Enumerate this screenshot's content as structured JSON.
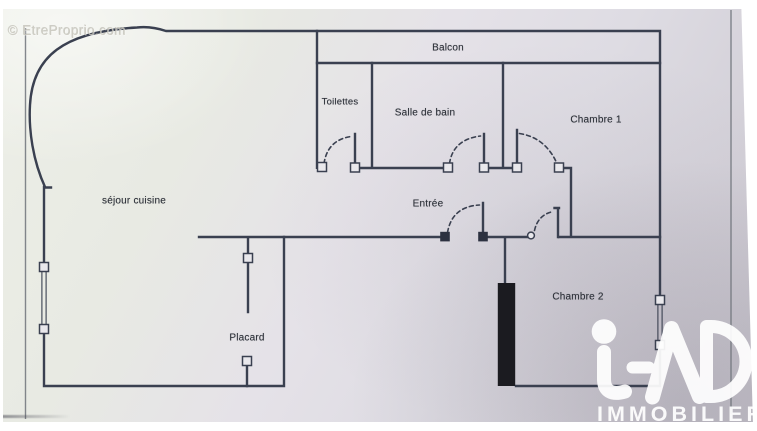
{
  "watermark": {
    "text": "© EtreProprio.com"
  },
  "rooms": {
    "balcon": "Balcon",
    "toilettes": "Toilettes",
    "salle_de_bain": "Salle de bain",
    "chambre_1": "Chambre 1",
    "chambre_2": "Chambre 2",
    "entree": "Entrée",
    "sejour_cuisine": "séjour cuisine",
    "placard": "Placard"
  },
  "logo": {
    "brand": "iAD",
    "subtitle": "IMMOBILIER"
  },
  "symbols": {
    "door_arc": "dashed quarter-circle swing",
    "window": "double thin line with end posts",
    "load_bearing_wall": "solid black filled wall"
  },
  "colors": {
    "paper": "#e6e4e7",
    "wall": "#3a4050",
    "thick_wall": "#1b1b20",
    "logo_white": "#ffffff",
    "watermark_gray": "#c8c6bc"
  }
}
